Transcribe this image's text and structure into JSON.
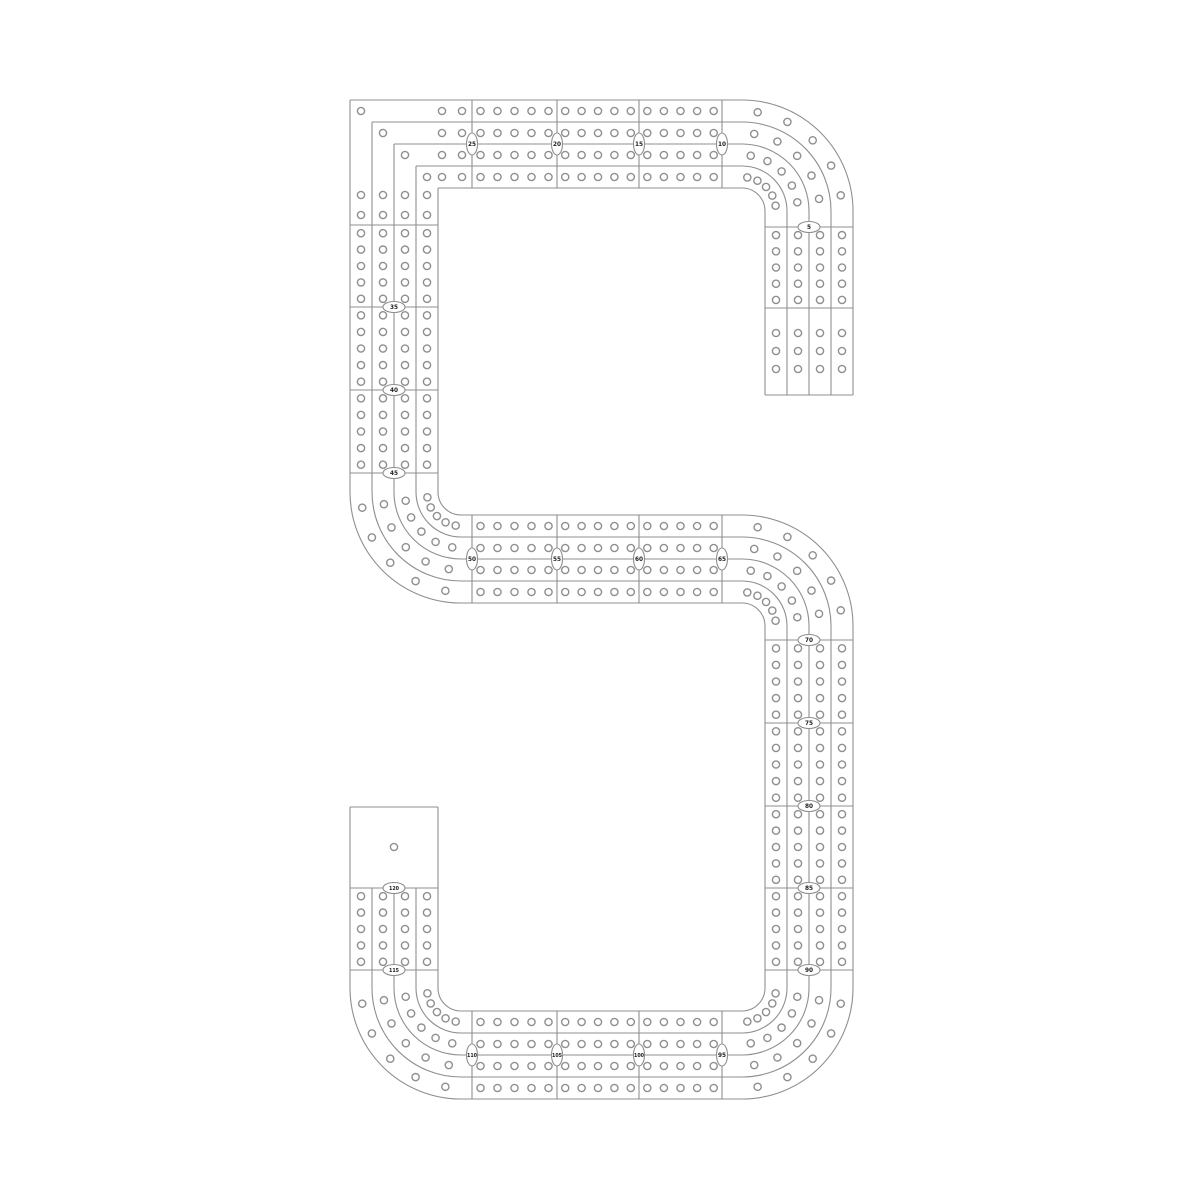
{
  "board": {
    "type": "cribbage-board-template",
    "shape": "numeral-5-track",
    "background_color": "#ffffff",
    "line_color": "#8f8f8f",
    "hole_fill_color": "#ffffff",
    "marker_fill_color": "#ffffff",
    "marker_text_color": "#1f1f1f",
    "lanes": 4,
    "lane_pitch": 22,
    "track_width": 88,
    "hole_radius": 3.6,
    "hole_stroke_width": 1.4,
    "line_stroke_width": 1.1,
    "holes_per_block": 5,
    "start_hole_count": 3,
    "scoring_holes_per_lane": 120,
    "game_hole_count": 1,
    "markers": [
      {
        "x": 809,
        "y": 227,
        "o": "h",
        "label": "5"
      },
      {
        "x": 722,
        "y": 144,
        "o": "v",
        "label": "10"
      },
      {
        "x": 639,
        "y": 144,
        "o": "v",
        "label": "15"
      },
      {
        "x": 557,
        "y": 144,
        "o": "v",
        "label": "20"
      },
      {
        "x": 472,
        "y": 144,
        "o": "v",
        "label": "25"
      },
      {
        "x": 394,
        "y": 307,
        "o": "h",
        "label": "35"
      },
      {
        "x": 394,
        "y": 390,
        "o": "h",
        "label": "40"
      },
      {
        "x": 394,
        "y": 473,
        "o": "h",
        "label": "45"
      },
      {
        "x": 472,
        "y": 559,
        "o": "v",
        "label": "50"
      },
      {
        "x": 557,
        "y": 559,
        "o": "v",
        "label": "55"
      },
      {
        "x": 639,
        "y": 559,
        "o": "v",
        "label": "60"
      },
      {
        "x": 722,
        "y": 559,
        "o": "v",
        "label": "65"
      },
      {
        "x": 809,
        "y": 640,
        "o": "h",
        "label": "70"
      },
      {
        "x": 809,
        "y": 723,
        "o": "h",
        "label": "75"
      },
      {
        "x": 809,
        "y": 806,
        "o": "h",
        "label": "80"
      },
      {
        "x": 809,
        "y": 888,
        "o": "h",
        "label": "85"
      },
      {
        "x": 809,
        "y": 970,
        "o": "h",
        "label": "90"
      },
      {
        "x": 722,
        "y": 1055,
        "o": "v",
        "label": "95"
      },
      {
        "x": 639,
        "y": 1055,
        "o": "v",
        "label": "100"
      },
      {
        "x": 557,
        "y": 1055,
        "o": "v",
        "label": "105"
      },
      {
        "x": 472,
        "y": 1055,
        "o": "v",
        "label": "110"
      },
      {
        "x": 394,
        "y": 970,
        "o": "h",
        "label": "115"
      },
      {
        "x": 394,
        "y": 888,
        "o": "h",
        "label": "120"
      }
    ],
    "geometry": {
      "edge_offsets": [
        0,
        22,
        44,
        66,
        88
      ],
      "lane_offsets": [
        11,
        33,
        55,
        77
      ],
      "curve_edge_radii": [
        23,
        45,
        67,
        89,
        111
      ],
      "curve_lane_radii": [
        34,
        56,
        78,
        100
      ],
      "top_bar": {
        "y_edge": 100,
        "x0": 350,
        "x1": 742,
        "nested_corner_x": 350,
        "bounds": [
          472,
          557,
          639,
          722
        ]
      },
      "left_vert": {
        "x_edge": 350,
        "y0": 100,
        "y1": 492,
        "nested_corner_y": 100,
        "bounds": [
          225,
          307,
          390,
          473
        ]
      },
      "mid_bar": {
        "y_edge": 515,
        "x0": 461,
        "x1": 742,
        "bounds": [
          472,
          557,
          639,
          722
        ]
      },
      "right_vert": {
        "x_edge": 765,
        "y0": 626,
        "y1": 988,
        "bounds": [
          640,
          723,
          806,
          888,
          970
        ]
      },
      "bot_bar": {
        "y_edge": 1011,
        "x0": 461,
        "x1": 742,
        "bounds": [
          472,
          557,
          639,
          722
        ]
      },
      "tail": {
        "x_edge": 765,
        "y0": 211,
        "y1": 395,
        "bounds": [
          227,
          308
        ],
        "close_y": 395,
        "start_hole_ys": [
          333,
          351,
          369
        ]
      },
      "stub": {
        "x_edge": 350,
        "y0": 807,
        "y1": 988,
        "bounds": [
          888,
          970
        ],
        "close_y": 807,
        "sep_from_y": 888,
        "game_hole": [
          394,
          847
        ]
      },
      "corner_block": {
        "bar_hole_xs": [
          442,
          462
        ],
        "vert_hole_ys": [
          195,
          215
        ]
      },
      "curves": [
        {
          "name": "top-right",
          "c": [
            742,
            211
          ],
          "a0": 270,
          "a1": 360
        },
        {
          "name": "left-middle",
          "c": [
            461,
            492
          ],
          "a0": 90,
          "a1": 180
        },
        {
          "name": "middle-right",
          "c": [
            742,
            626
          ],
          "a0": 270,
          "a1": 360
        },
        {
          "name": "bottom-right",
          "c": [
            742,
            988
          ],
          "a0": 0,
          "a1": 90
        },
        {
          "name": "bottom-left",
          "c": [
            461,
            988
          ],
          "a0": 90,
          "a1": 180
        }
      ]
    }
  }
}
